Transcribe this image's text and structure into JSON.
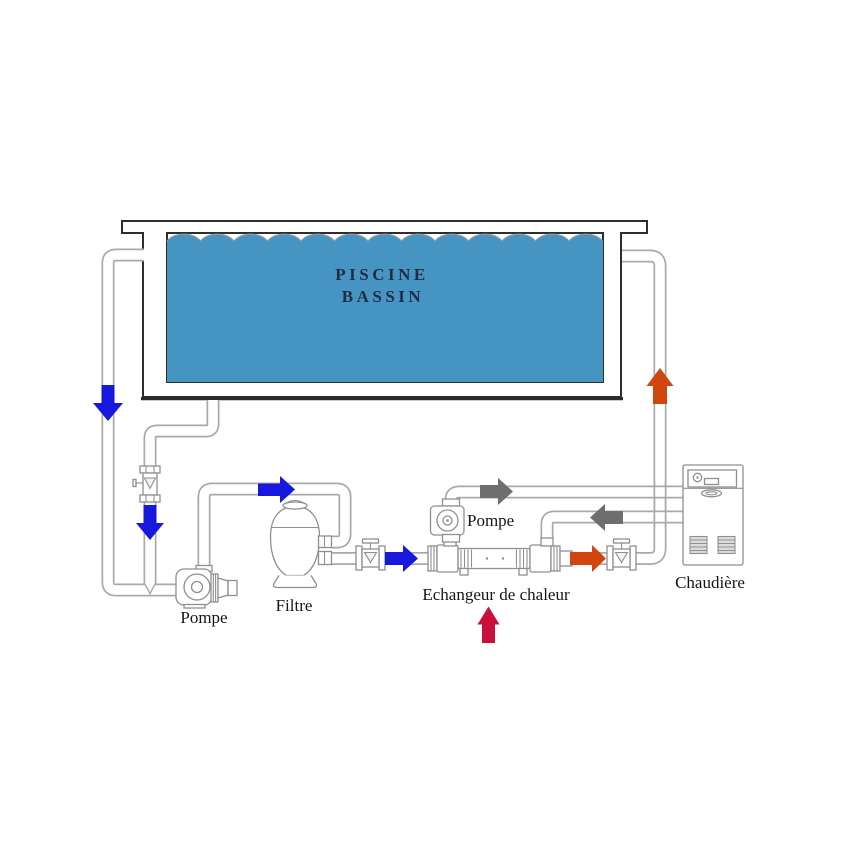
{
  "diagram": {
    "pool": {
      "name_line1": "PISCINE",
      "name_line2": "BASSIN"
    },
    "labels": {
      "main_pump": "Pompe",
      "filter": "Filtre",
      "circulator_pump": "Pompe",
      "heat_exchanger": "Echangeur de chaleur",
      "boiler": "Chaudière"
    },
    "colors": {
      "water": "#4694c2",
      "pool_flow_arrow": "#1717dd",
      "primary_flow_arrow": "#6e6e6e",
      "heated_flow_arrow": "#d2450e",
      "heat_source_arrow": "#c9103a"
    }
  }
}
